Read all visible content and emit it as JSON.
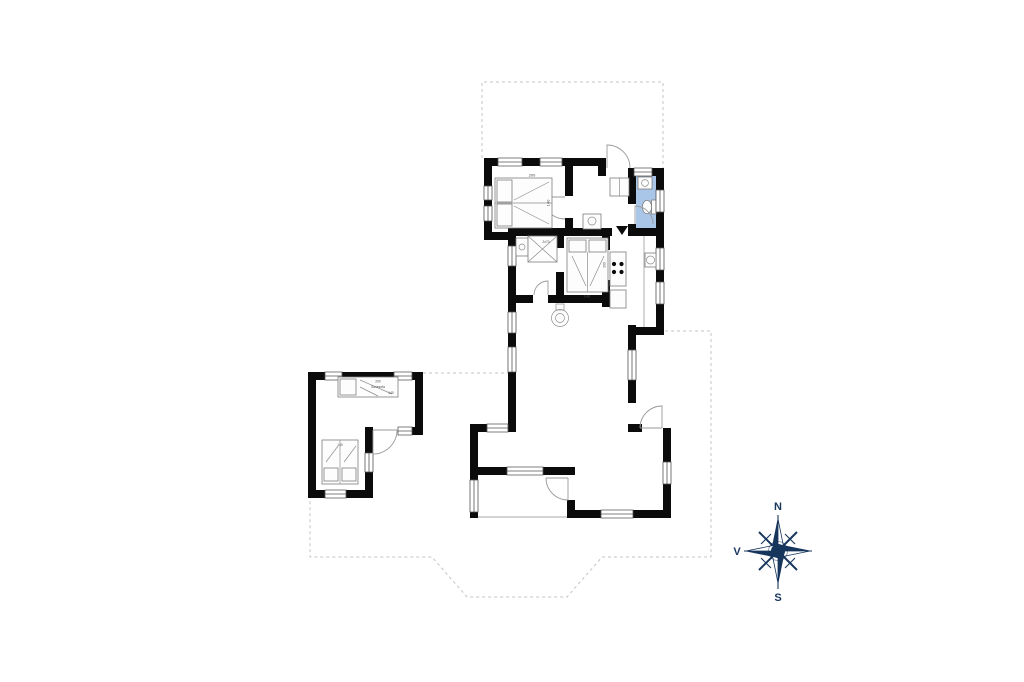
{
  "page": {
    "type": "floor-plan",
    "background": "#ffffff"
  },
  "colors": {
    "wall": "#0b0b0b",
    "bathroom_fill": "#a9c6e8",
    "dashed_line": "#c4c4c4",
    "thin_line": "#8c8c8c",
    "compass": "#17365c"
  },
  "compass": {
    "n": "N",
    "e": "Ø",
    "s": "S",
    "w": "V"
  },
  "labels": {
    "bed_nw_length": "200",
    "bed_nw_width": "140",
    "bunk": "2x70",
    "bed_mid_length": "200",
    "bed_mid_width": "140",
    "sofa_length": "200",
    "sofa_name": "Sovesofa",
    "sofa_width": "140",
    "annex_bed_width": "140"
  }
}
